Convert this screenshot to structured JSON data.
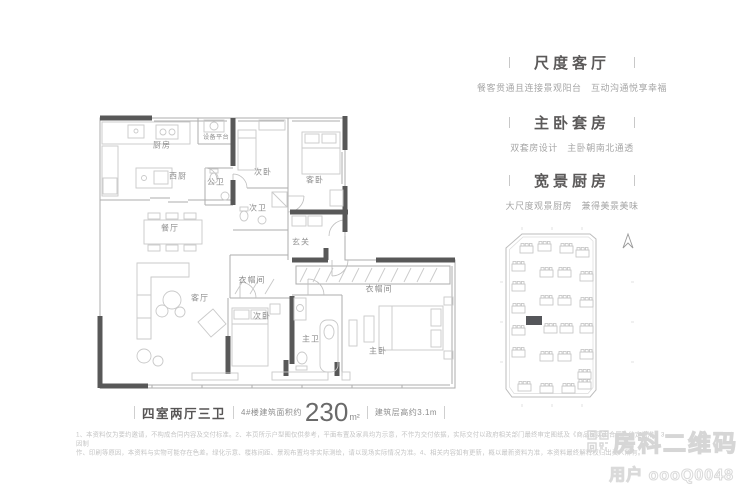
{
  "floorplan": {
    "rooms": [
      {
        "label": "厨房"
      },
      {
        "label": "设备平台"
      },
      {
        "label": "西厨"
      },
      {
        "label": "公卫"
      },
      {
        "label": "次卧"
      },
      {
        "label": "客卧"
      },
      {
        "label": "次卫"
      },
      {
        "label": "餐厅"
      },
      {
        "label": "玄关"
      },
      {
        "label": "客厅"
      },
      {
        "label": "衣帽间"
      },
      {
        "label": "次卧"
      },
      {
        "label": "主卫"
      },
      {
        "label": "衣帽间"
      },
      {
        "label": "主卧"
      }
    ]
  },
  "features": [
    {
      "title": "尺度客厅",
      "subtitle": "餐客贯通且连接景观阳台　互动沟通悦享幸福"
    },
    {
      "title": "主卧套房",
      "subtitle": "双套房设计　主卧朝南北通透"
    },
    {
      "title": "宽景厨房",
      "subtitle": "大尺度观景厨房　兼得美景美味"
    }
  ],
  "caption": {
    "layout_type": "四室两厅三卫",
    "area_prefix": "4#楼建筑面积约",
    "area_value": "230",
    "area_unit": "m²",
    "height_note": "建筑层高约3.1m"
  },
  "disclaimer": {
    "line1": "1、本资料仅为要约邀请，不构成合同内容及交付标准。2、本页所示户型图仅供参考，平面布置及家具均为示意，不作为交付依据，实际交付以政府相关部门最终审定图纸及《商品房买卖合同》约定为准。3、因制",
    "line2": "作、印刷等原因，本资料与实物可能存在色差。绿化示意、楼栋间距、景观布置均非实际测绘，请以现场实际情况为准。4、相关内容如有更新，概以最新资料为准，本资料最终解释权归出卖人所有。"
  },
  "watermark": {
    "title": "房科二维码",
    "subtitle": "用户 oooQ0048"
  },
  "siteplan": {
    "highlight_color": "#55565a"
  },
  "colors": {
    "wall": "#585858",
    "thin_line": "#adadad",
    "furniture": "#c9c9c9",
    "text_primary": "#575555",
    "text_muted": "#a6a6a6"
  }
}
